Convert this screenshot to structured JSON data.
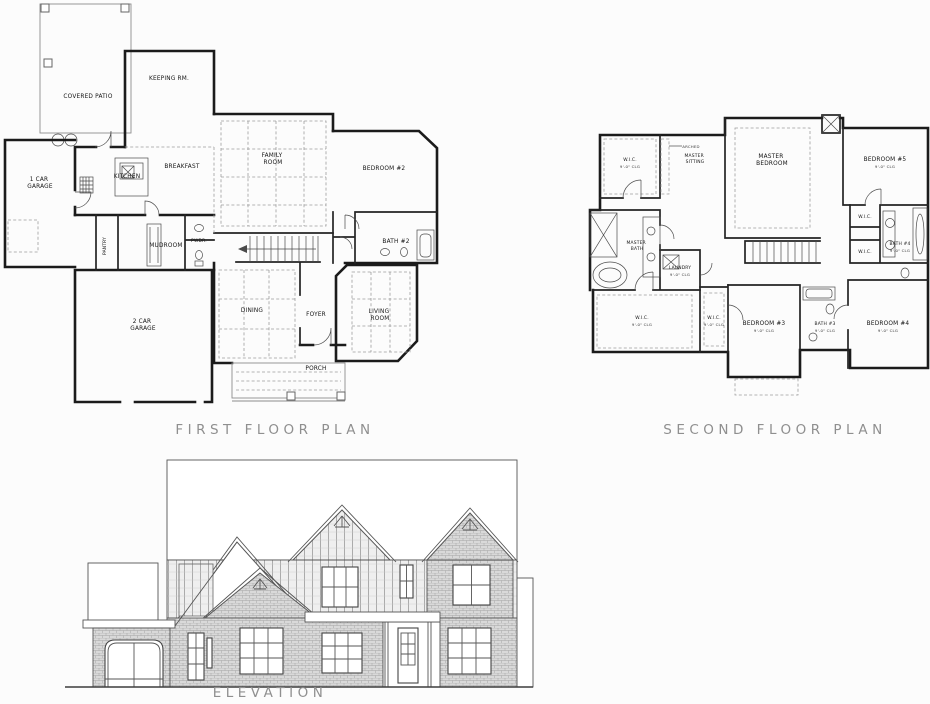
{
  "document": {
    "background": "#fcfcfc",
    "ink": "#1b1b1b",
    "dashed_grid_color": "#9c9c9c",
    "caption_color": "#8f8f8f",
    "brick_tone": "#d9d9d9"
  },
  "captions": {
    "first_floor": "FIRST FLOOR PLAN",
    "second_floor": "SECOND FLOOR PLAN",
    "elevation": "ELEVATION"
  },
  "first_floor": {
    "rooms": {
      "covered_patio": "COVERED PATIO",
      "keeping_rm": "KEEPING RM.",
      "one_car_garage": [
        "1 CAR",
        "GARAGE"
      ],
      "kitchen": "KITCHEN",
      "breakfast": "BREAKFAST",
      "family_room": [
        "FAMILY",
        "ROOM"
      ],
      "bedroom_2": "BEDROOM #2",
      "bath_2": "BATH #2",
      "pantry": "PANTRY",
      "mudroom": "MUDROOM",
      "powder": "PWDR.",
      "two_car_garage": [
        "2 CAR",
        "GARAGE"
      ],
      "dining": "DINING",
      "foyer": "FOYER",
      "living_room": [
        "LIVING",
        "ROOM"
      ],
      "porch": "PORCH"
    }
  },
  "second_floor": {
    "ceiling_note": "9'-0\" CLG",
    "arched_note": "ARCHED",
    "rooms": {
      "wic": "W.I.C.",
      "master_sitting": [
        "MASTER",
        "SITTING"
      ],
      "master_bedroom": [
        "MASTER",
        "BEDROOM"
      ],
      "bedroom_5": "BEDROOM #5",
      "master_bath": [
        "MASTER",
        "BATH"
      ],
      "laundry": "LAUNDRY",
      "bath_4": "BATH #4",
      "bedroom_3": "BEDROOM #3",
      "bath_3": "BATH #3",
      "bedroom_4": "BEDROOM #4"
    }
  }
}
